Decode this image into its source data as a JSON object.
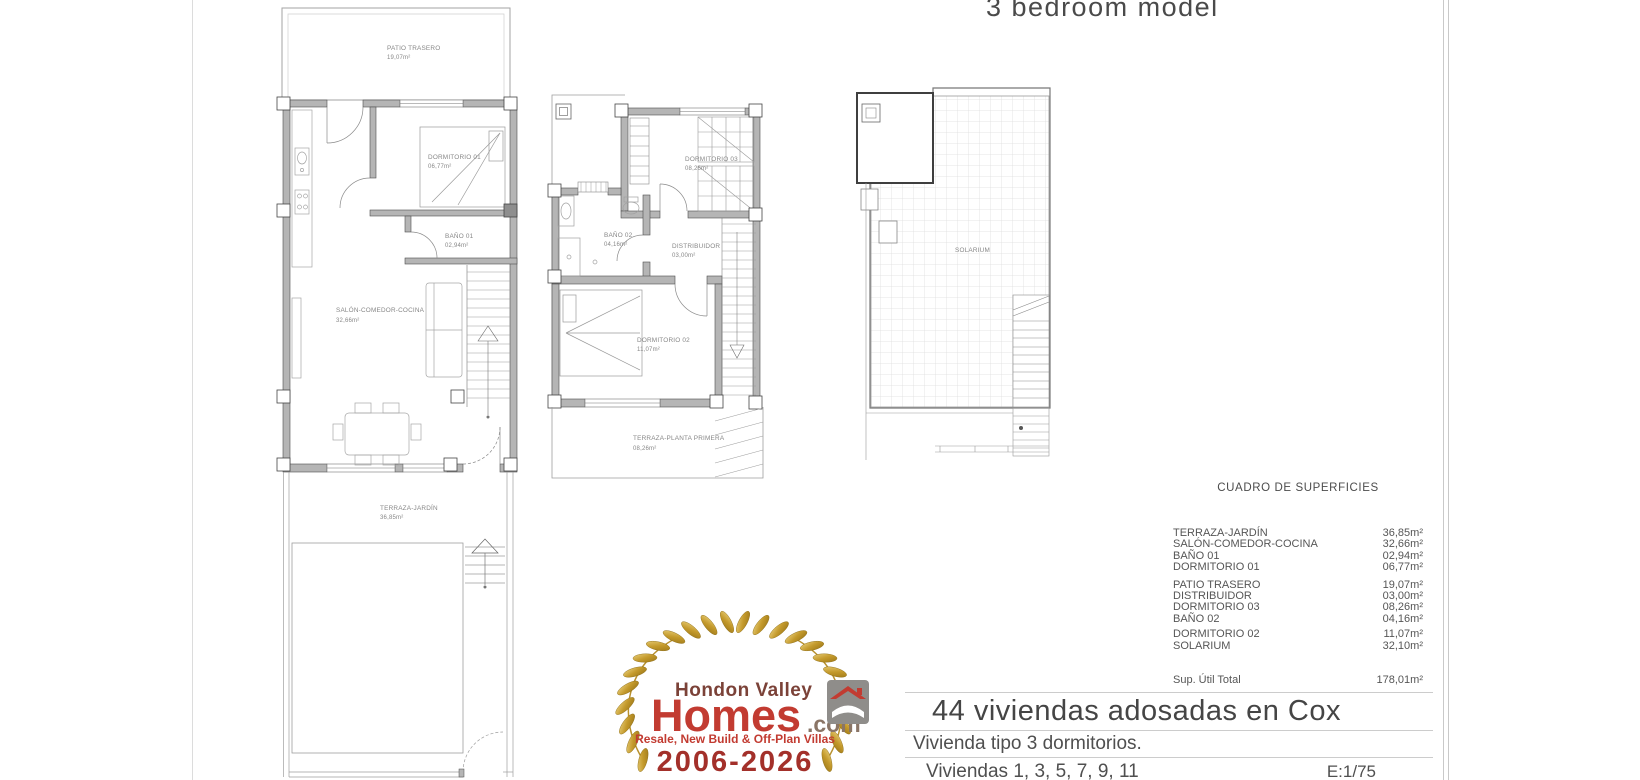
{
  "header": {
    "model_label": "3 bedroom model"
  },
  "plans": {
    "ground_floor": {
      "patio_trasero": {
        "name": "PATIO TRASERO",
        "area": "19,07m²"
      },
      "dormitorio_01": {
        "name": "DORMITORIO 01",
        "area": "06,77m²"
      },
      "bano_01": {
        "name": "BAÑO 01",
        "area": "02,94m²"
      },
      "salon": {
        "name": "SALÓN-COMEDOR-COCINA",
        "area": "32,66m²"
      },
      "terraza_jardin": {
        "name": "TERRAZA-JARDÍN",
        "area": "36,85m²"
      }
    },
    "first_floor": {
      "dormitorio_03": {
        "name": "DORMITORIO 03",
        "area": "08,26m²"
      },
      "bano_02": {
        "name": "BAÑO 02",
        "area": "04,16m²"
      },
      "distribuidor": {
        "name": "DISTRIBUIDOR",
        "area": "03,00m²"
      },
      "dormitorio_02": {
        "name": "DORMITORIO 02",
        "area": "11,07m²"
      },
      "terraza_primera": {
        "name": "TERRAZA-PLANTA PRIMERA",
        "area": "08,26m²"
      }
    },
    "roof": {
      "solarium": {
        "name": "SOLARIUM"
      }
    }
  },
  "surface_table": {
    "title": "CUADRO DE SUPERFICIES",
    "rows": [
      {
        "label": "TERRAZA-JARDÍN",
        "value": "36,85m²"
      },
      {
        "label": "SALÓN-COMEDOR-COCINA",
        "value": "32,66m²"
      },
      {
        "label": "BAÑO 01",
        "value": "02,94m²"
      },
      {
        "label": "DORMITORIO 01",
        "value": "06,77m²"
      },
      {
        "label": "PATIO TRASERO",
        "value": "19,07m²"
      },
      {
        "label": "DISTRIBUIDOR",
        "value": "03,00m²"
      },
      {
        "label": "DORMITORIO 03",
        "value": "08,26m²"
      },
      {
        "label": "BAÑO 02",
        "value": "04,16m²"
      },
      {
        "label": "DORMITORIO 02",
        "value": "11,07m²"
      },
      {
        "label": "SOLARIUM",
        "value": "32,10m²"
      }
    ],
    "total_label": "Sup. Útil Total",
    "total_value": "178,01m²"
  },
  "title_block": {
    "project_title": "44 viviendas adosadas en Cox",
    "subtitle": "Vivienda tipo 3 dormitorios.",
    "units": "Viviendas 1, 3, 5, 7, 9, 11",
    "scale": "E:1/75"
  },
  "logo": {
    "brand_top": "Hondon Valley",
    "brand_main": "Homes",
    "brand_suffix": ".com",
    "tagline": "Resale, New Build & Off-Plan Villas",
    "years": "2006-2026",
    "colors": {
      "red": "#c23b31",
      "maroon": "#7b4238",
      "dark_red": "#a3302a",
      "gold": "#c49a2c",
      "gray": "#8f8d8a"
    }
  }
}
